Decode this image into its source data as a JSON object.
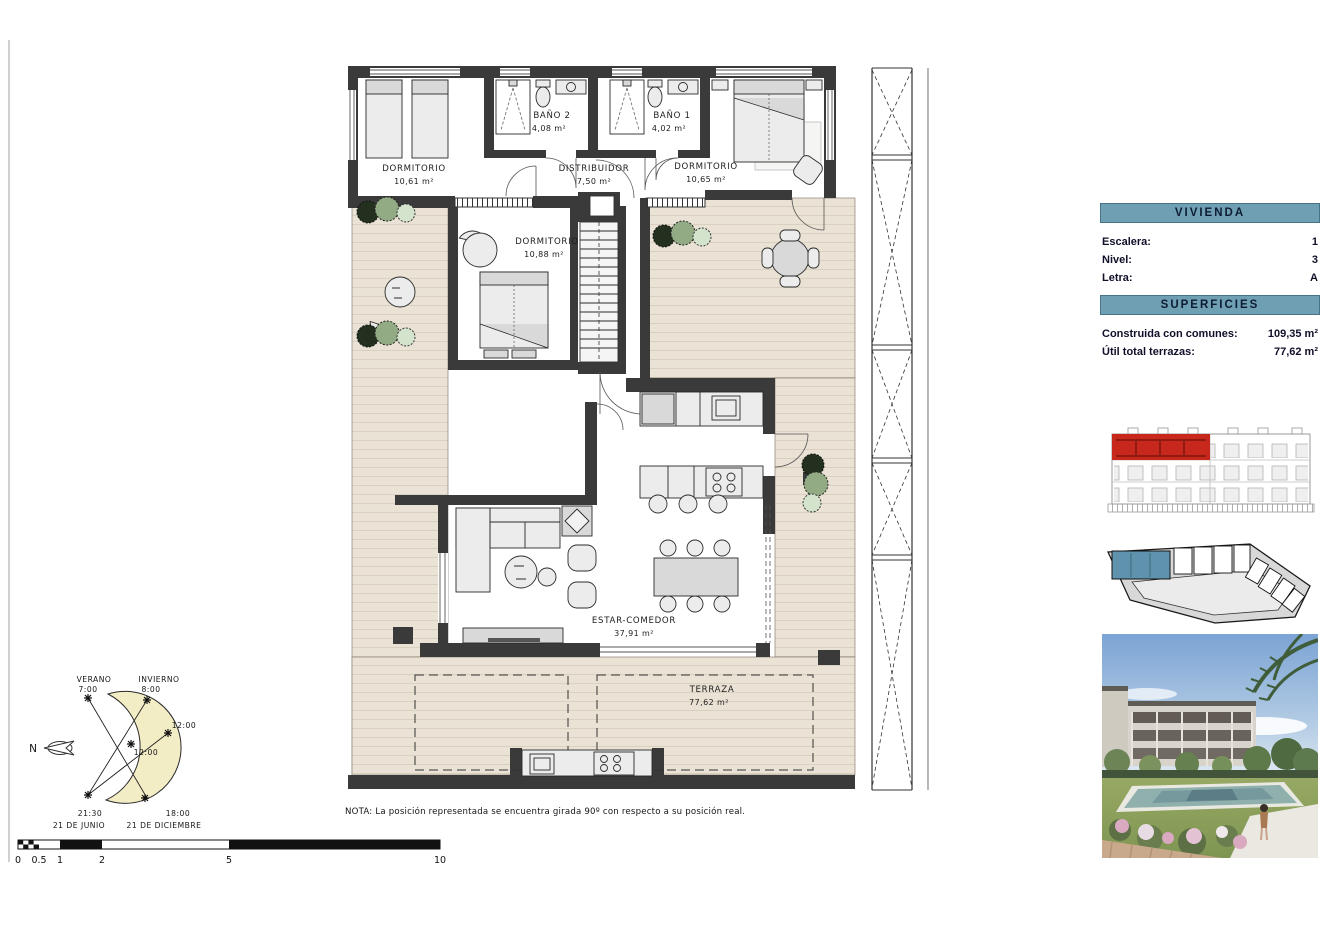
{
  "plan": {
    "rooms": [
      {
        "name": "DORMITORIO",
        "area": "10,61 m²"
      },
      {
        "name": "BAÑO 2",
        "area": "4,08 m²"
      },
      {
        "name": "DISTRIBUIDOR",
        "area": "7,50 m²"
      },
      {
        "name": "BAÑO 1",
        "area": "4,02 m²"
      },
      {
        "name": "DORMITORIO",
        "area": "10,65 m²"
      },
      {
        "name": "DORMITORIO",
        "area": "10,88 m²"
      },
      {
        "name": "ESTAR-COMEDOR",
        "area": "37,91 m²"
      },
      {
        "name": "TERRAZA",
        "area": "77,62 m²"
      }
    ],
    "note": "NOTA: La posición representada se encuentra girada 90º con respecto a su posición real."
  },
  "panel": {
    "vivienda_title": "VIVIENDA",
    "fields": [
      {
        "label": "Escalera:",
        "value": "1"
      },
      {
        "label": "Nivel:",
        "value": "3"
      },
      {
        "label": "Letra:",
        "value": "A"
      }
    ],
    "superficies_title": "SUPERFICIES",
    "areas": [
      {
        "label": "Construida con comunes:",
        "value": "109,35 m²"
      },
      {
        "label": "Útil total terrazas:",
        "value": "77,62 m²"
      }
    ]
  },
  "sun": {
    "verano": "VERANO",
    "verano_time": "7:00",
    "invierno": "INVIERNO",
    "invierno_time": "8:00",
    "noon_outer": "12:00",
    "noon_inner": "12:00",
    "summer_evening": "21:30",
    "summer_date": "21 DE JUNIO",
    "winter_evening": "18:00",
    "winter_date": "21 DE DICIEMBRE",
    "north": "N"
  },
  "scale": {
    "ticks": [
      "0",
      "0.5",
      "1",
      "2",
      "5",
      "10"
    ]
  },
  "colors": {
    "accent_blue": "#6f9fb3",
    "highlight_red": "#c8271c",
    "highlight_blue": "#5f93ad",
    "terrace_beige": "#eae2d4",
    "wall": "#3a3a3a"
  }
}
